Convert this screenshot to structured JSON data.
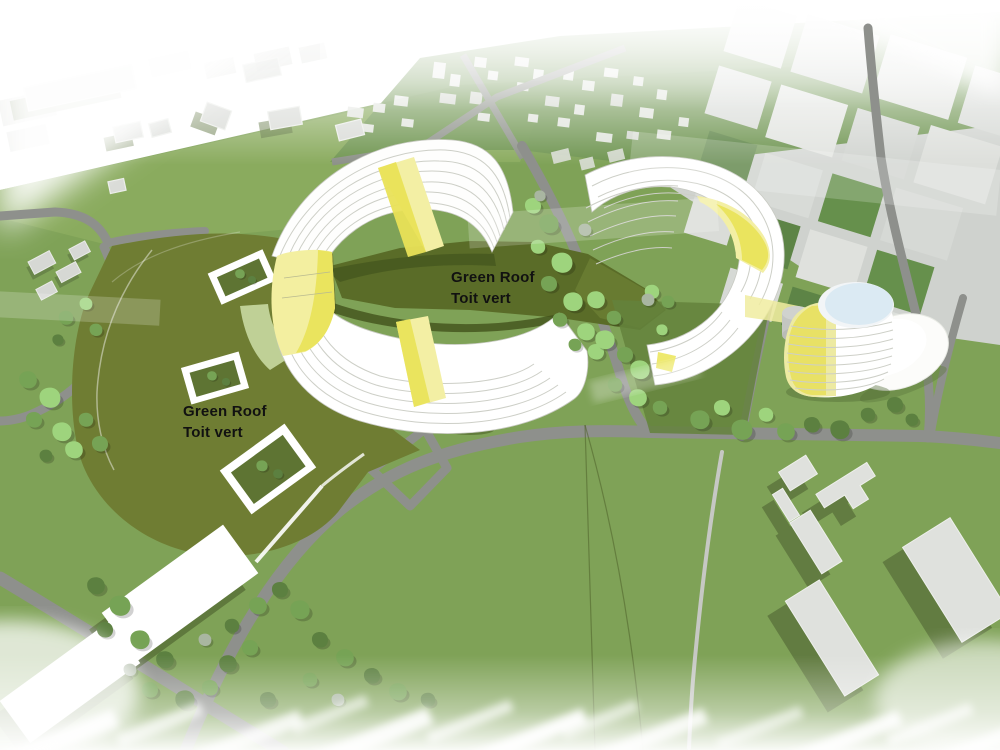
{
  "scene": {
    "description": "Aerial 3D architectural massing rendering: two white crescent-shaped buildings with yellow accents enclosing a shared dark-green roof courtyard, a yellow-striped cylindrical tower with pale blue roof, an egg-shaped pavilion, olive green-roof parkland with skylights, roads, trees and surrounding city blocks fading to white fog at the edges"
  },
  "annotations": [
    {
      "id": "courtyard",
      "line1": "Green Roof",
      "line2": "Toit vert"
    },
    {
      "id": "park",
      "line1": "Green Roof",
      "line2": "Toit vert"
    }
  ],
  "colors": {
    "field_green": "#8aab5e",
    "lawn_green": "#7fa257",
    "park_olive": "#6f7d33",
    "courtyard_green": "#5a6c28",
    "courtyard_shadow": "#46571d",
    "road_gray": "#8e908c",
    "building_white": "#ffffff",
    "block_gray": "#d9dbd7",
    "accent_yellow_bright": "#e9e257",
    "accent_yellow_pale": "#f3efa4",
    "tower_roof_blue": "#dbeaf3",
    "tree_light": "#9ed47d",
    "tree_dark": "#5c8040",
    "label_text": "#111111"
  }
}
